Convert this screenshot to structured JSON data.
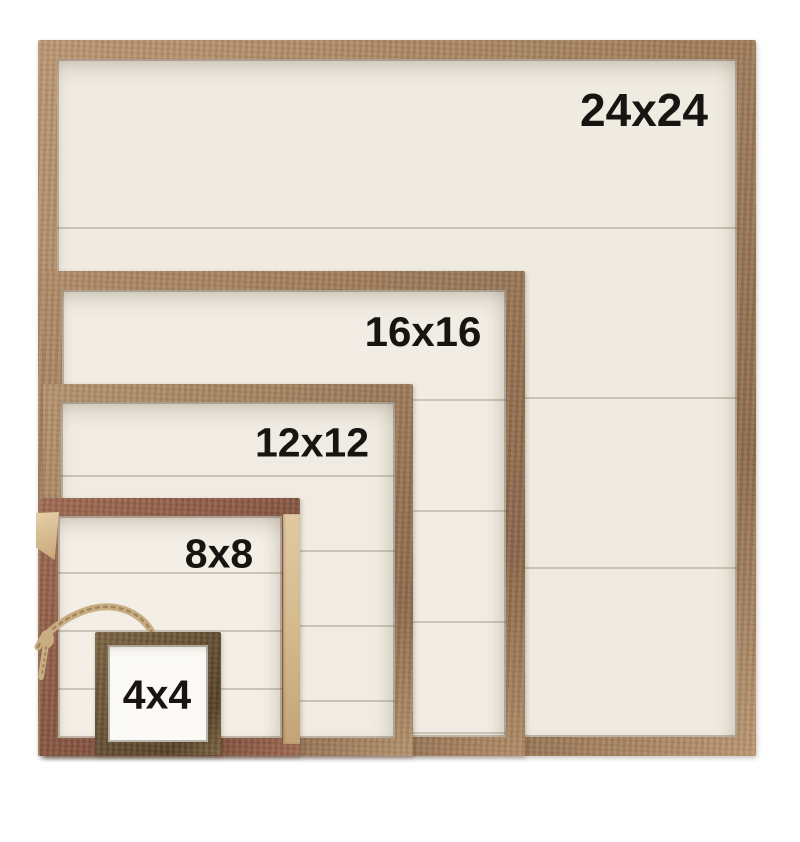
{
  "page": {
    "kind": "product-size-comparison-photo",
    "alt_text": "Five nested rustic wood shadowbox sign frames stacked in front of each other, each labeled with its square size",
    "background_color": "#ffffff"
  },
  "frames": [
    {
      "name": "frame-24x24",
      "label": "24x24",
      "size_inches": 24,
      "wood_light": "#bd9873",
      "wood_dark": "#8f6d4c",
      "panel": "#efebe1"
    },
    {
      "name": "frame-16x16",
      "label": "16x16",
      "size_inches": 16,
      "wood_light": "#b28d68",
      "wood_dark": "#8a684a",
      "panel": "#f1ede4"
    },
    {
      "name": "frame-12x12",
      "label": "12x12",
      "size_inches": 12,
      "wood_light": "#b6936e",
      "wood_dark": "#8d6b4c",
      "panel": "#f0ece3"
    },
    {
      "name": "frame-8x8",
      "label": "8x8",
      "size_inches": 8,
      "wood_light": "#a06a52",
      "wood_dark": "#7a4b38",
      "panel": "#f3efe7"
    },
    {
      "name": "frame-4x4",
      "label": "4x4",
      "size_inches": 4,
      "wood_light": "#7c6443",
      "wood_dark": "#564226",
      "panel": "#fbfaf6"
    }
  ],
  "accents": {
    "label_color": "#171411",
    "twine_color": "#c9ae83",
    "twine_fiber_color": "#a2875c"
  }
}
